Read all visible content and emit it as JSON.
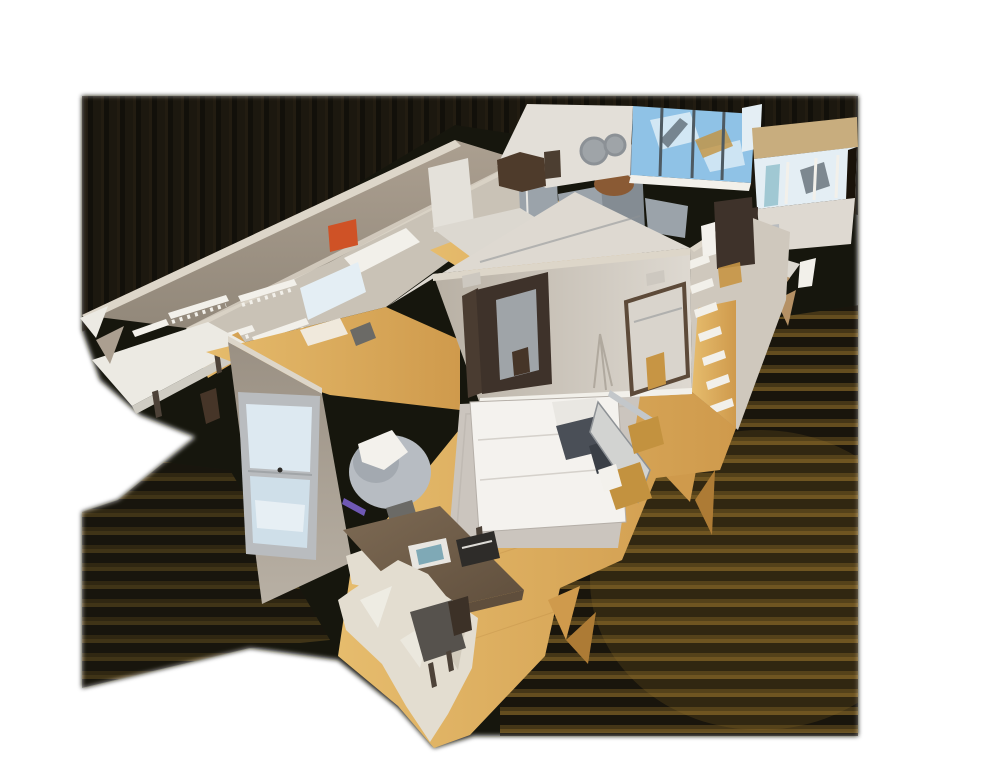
{
  "view": {
    "title": "3D dollhouse cutaway view of a scanned apartment",
    "type": "dollhouse-3d-model",
    "background": "#ffffff"
  },
  "scene": {
    "rooms": [
      {
        "name": "walk-in-closet",
        "features": [
          "wall shelf rails with hooks",
          "white shelf",
          "floor vase"
        ]
      },
      {
        "name": "kitchen",
        "features": [
          "stainless fridge",
          "steel oven cabinet",
          "white counters",
          "copper pot",
          "sink"
        ]
      },
      {
        "name": "living-room",
        "features": [
          "floor-to-ceiling windows with sky",
          "two round mirrors",
          "dark sofa",
          "framed art"
        ]
      },
      {
        "name": "right-wing",
        "features": [
          "tan soffit beam",
          "bright windows",
          "dark doorway",
          "framed picture",
          "white counter with papers"
        ]
      },
      {
        "name": "hallway",
        "features": [
          "bathroom door with towel",
          "white ladder shelf",
          "closet doorway"
        ]
      },
      {
        "name": "bedroom",
        "features": [
          "white double bed",
          "dark pillows",
          "area rug",
          "gray armchair with throw",
          "mirrored open door",
          "sash window",
          "purple LED floor strip"
        ]
      },
      {
        "name": "desk-nook",
        "features": [
          "dark wood desk",
          "open book",
          "dark typewriter-like object",
          "cream chairs"
        ]
      }
    ]
  },
  "palette": {
    "background": "#ffffff",
    "shadowBase": "#191209",
    "stripeA": "#221910",
    "stripeB": "#0e0a06",
    "stripeC": "#2e2115",
    "bandDark": "#1c140c",
    "bandGold": "#a37a2e",
    "bandGold2": "#6b501f",
    "wallTaupe": "#ab9f90",
    "wallDark": "#92887a",
    "wallLight": "#c9c2b6",
    "wallLight2": "#cfc8bd",
    "wallMid": "#b8b0a4",
    "wallLit": "#ded9d1",
    "wallWhiteLit": "#e3dfd8",
    "wallTop": "#ddd6c9",
    "wallShade": "#9a9083",
    "railWhite": "#f2f0ea",
    "shelfWhite": "#eceae3",
    "shelfShade": "#cfccc3",
    "woodLight": "#e6bc6d",
    "woodMid": "#cf9a4c",
    "woodDark": "#ad7b35",
    "rug": "#cbc5be",
    "rugEdge": "#b5afa8",
    "bedWhite": "#f4f2ee",
    "pillowWhite": "#e9e7e2",
    "pillowDark": "#4a4f57",
    "pillowDark2": "#3a3f46",
    "panelGray": "#d2d3d1",
    "railSteel": "#c3c7ca",
    "chairGray": "#b7bcc2",
    "chairShade": "#a3a9b0",
    "towelWhite": "#f3f1ec",
    "chairCream": "#e3ddd0",
    "chairCreamDark": "#c9c2b2",
    "seatDark": "#56524d",
    "holeBrown": "#3c3127",
    "deskWood": "#7d6a54",
    "deskEdge": "#5f4e3c",
    "bookTeal": "#7fa9b6",
    "objDark": "#2e2c29",
    "clutterDark": "#6b6a66",
    "clutterLight": "#e8e6e1",
    "doorDark": "#3e322a",
    "doorLeaf": "#4a3c31",
    "doorFrame": "#5d4a39",
    "doorwayInner": "#d9d4cc",
    "mirrorGlass": "#9fa4a8",
    "vaseBrown": "#463528",
    "goldLight": "#c79544",
    "goldWood": "#c3923f",
    "steel": "#9ba3aa",
    "steelDark": "#848c93",
    "cabWhite": "#e4e1da",
    "counterLight": "#dcd8d0",
    "copper": "#8a5a34",
    "skyBlue": "#8fc2e6",
    "skyPale": "#dde9f1",
    "skyPale2": "#cfdfe9",
    "cloudWhite": "#f6fafc",
    "mullionDark": "#4e5a62",
    "windowBright": "#e4eef4",
    "tealGlass": "#8fbecb",
    "darkGlass": "#38454c",
    "beamTan": "#c8ad7e",
    "frameGray": "#b9bcbf",
    "frameDark": "#8e9296",
    "artDark": "#4c3e31",
    "sofaBrown": "#4e3b2b",
    "accentOrange": "#cf5226",
    "ledPurple": "#7f64d2",
    "ventGray": "#cdc8c0",
    "slotDark": "#2e261e",
    "legDark": "#4d4238",
    "meshTan": "#b59165",
    "shadowSoft": "#8f877c",
    "mirrorRing": "#8c9196"
  }
}
